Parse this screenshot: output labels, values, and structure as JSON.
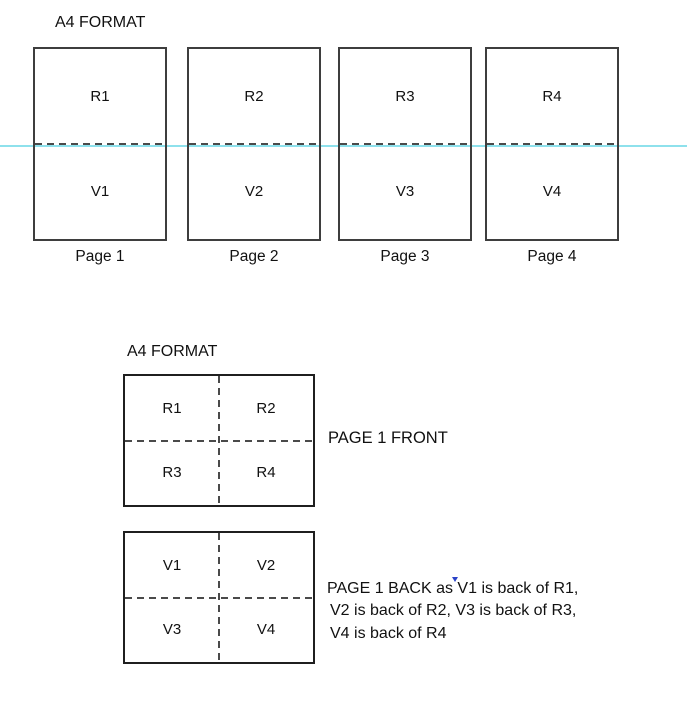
{
  "colors": {
    "fold_line": "#8EE1EC",
    "sheet_border": "#3E3E3E",
    "box_border": "#1F1F1F",
    "dash": "#4A4A4A",
    "text": "#111111",
    "caret": "#2B43C8"
  },
  "top": {
    "label": "A4 FORMAT",
    "pages": [
      {
        "recto": "R1",
        "verso": "V1",
        "caption": "Page 1"
      },
      {
        "recto": "R2",
        "verso": "V2",
        "caption": "Page 2"
      },
      {
        "recto": "R3",
        "verso": "V3",
        "caption": "Page 3"
      },
      {
        "recto": "R4",
        "verso": "V4",
        "caption": "Page 4"
      }
    ]
  },
  "bottom": {
    "label": "A4 FORMAT",
    "front": {
      "cells": [
        "R1",
        "R2",
        "R3",
        "R4"
      ],
      "caption": "PAGE 1 FRONT"
    },
    "back": {
      "cells": [
        "V1",
        "V2",
        "V3",
        "V4"
      ],
      "caption_lines": [
        "PAGE 1 BACK as V1 is back of R1,",
        "V2 is back of R2, V3 is back of R3,",
        "V4 is back of R4"
      ]
    }
  }
}
